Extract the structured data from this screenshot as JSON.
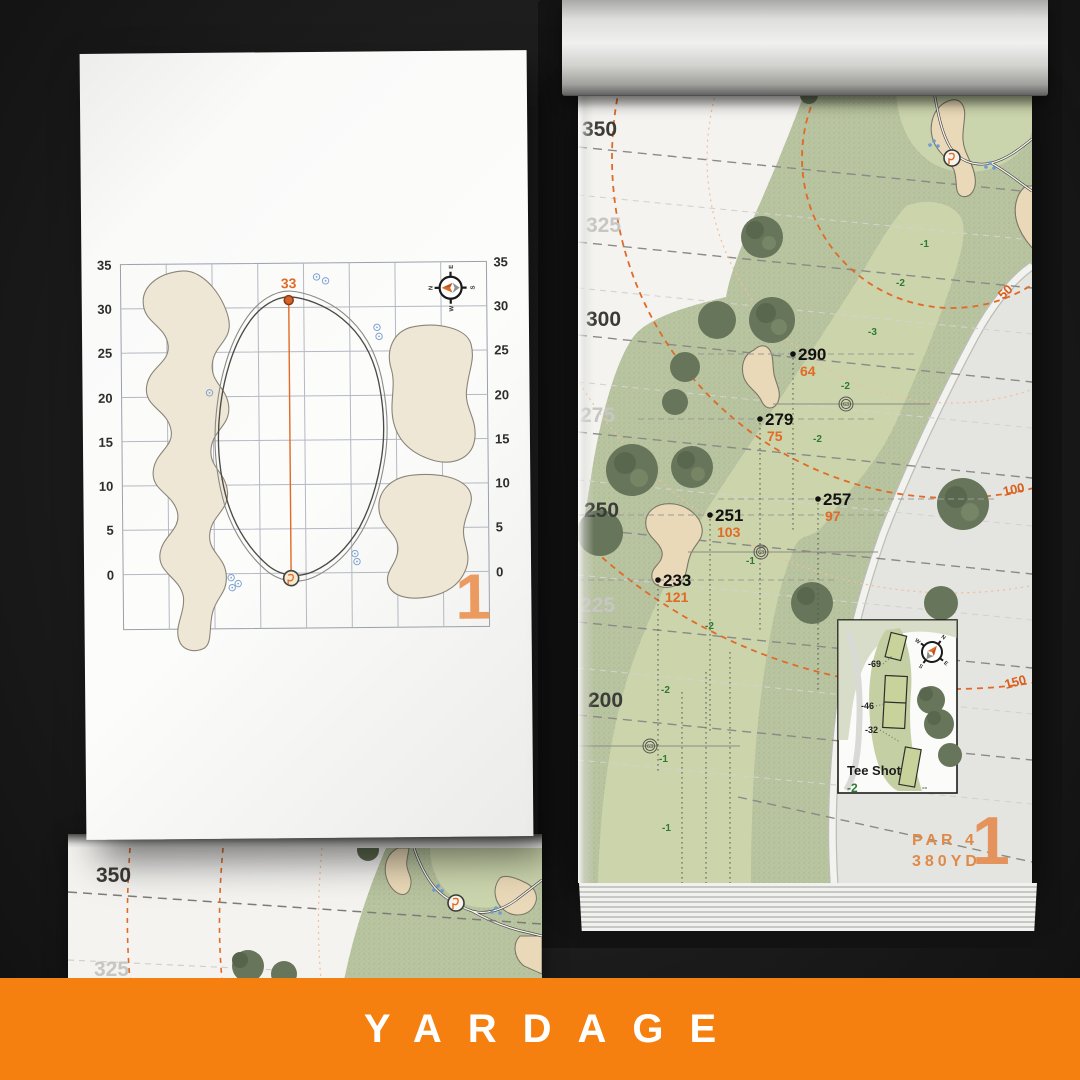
{
  "banner": {
    "title": "YARDAGE",
    "color": "#f5800f"
  },
  "colors": {
    "accent_orange": "#e06a26",
    "banner_orange": "#f5800f",
    "slope_green": "#2f7a33",
    "fairway": "#ccd4ab",
    "rough": "#b9c4a0",
    "bunker": "#ead9b8"
  },
  "left_page": {
    "pin_distance": "33",
    "hole_number": "1",
    "axis_labels": [
      "35",
      "30",
      "25",
      "20",
      "15",
      "10",
      "5",
      "0"
    ],
    "compass": {
      "n": "N",
      "e": "E",
      "s": "S",
      "w": "W"
    }
  },
  "right_page": {
    "distance_labels": [
      "350",
      "325",
      "300",
      "275",
      "250",
      "225",
      "200"
    ],
    "arc_labels": [
      "50",
      "100",
      "150"
    ],
    "markers": [
      {
        "carry": "290",
        "to_pin": "64"
      },
      {
        "carry": "279",
        "to_pin": "75"
      },
      {
        "carry": "257",
        "to_pin": "97"
      },
      {
        "carry": "251",
        "to_pin": "103"
      },
      {
        "carry": "233",
        "to_pin": "121"
      }
    ],
    "slopes": [
      "-1",
      "-2",
      "-3",
      "-2",
      "-2",
      "-1",
      "-2",
      "-2",
      "-1",
      "-1"
    ],
    "sprinkler_value": "63",
    "tee_box": {
      "title": "Tee Shot",
      "slope": "-2",
      "tee_offsets": [
        "-69",
        "-46",
        "-32"
      ],
      "dash_mark": "--"
    },
    "hole": {
      "number": "1",
      "par": "PAR 4",
      "yardage": "380YD"
    },
    "compass": {
      "n": "N",
      "e": "E",
      "s": "S",
      "w": "W"
    }
  },
  "back_page": {
    "distance_labels": [
      "350",
      "325"
    ]
  }
}
